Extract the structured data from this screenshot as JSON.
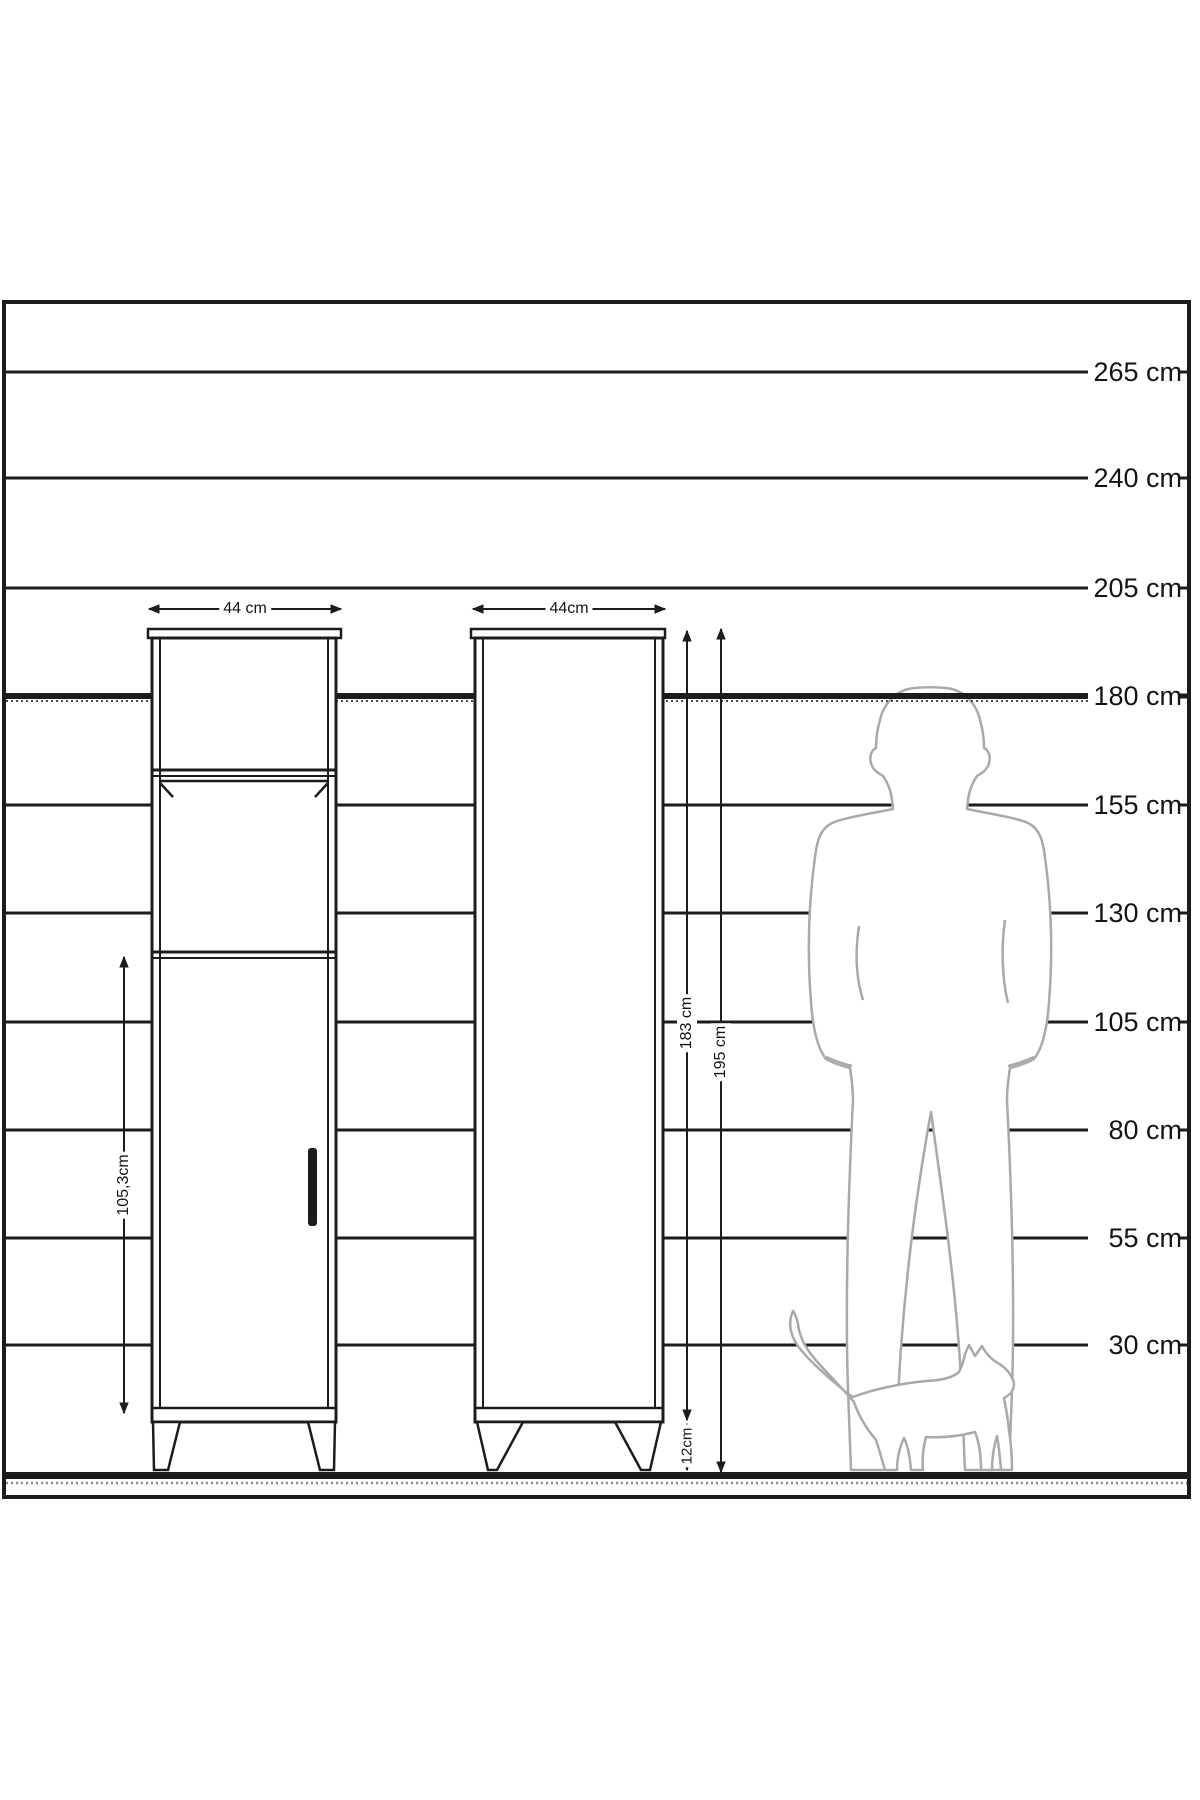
{
  "diagram": {
    "scale_labels": [
      "265 cm",
      "240 cm",
      "205 cm",
      "180 cm",
      "155 cm",
      "130 cm",
      "105 cm",
      "80 cm",
      "55 cm",
      "30 cm"
    ],
    "front_view": {
      "width_label": "44 cm",
      "door_height_label": "105,3cm"
    },
    "side_view": {
      "depth_label": "44cm",
      "body_height_label": "183 cm",
      "total_height_label": "195 cm",
      "leg_height_label": "12cm"
    },
    "colors": {
      "line": "#1c1c1c",
      "silhouette_stroke": "#a9a9a9",
      "background": "#ffffff"
    }
  }
}
